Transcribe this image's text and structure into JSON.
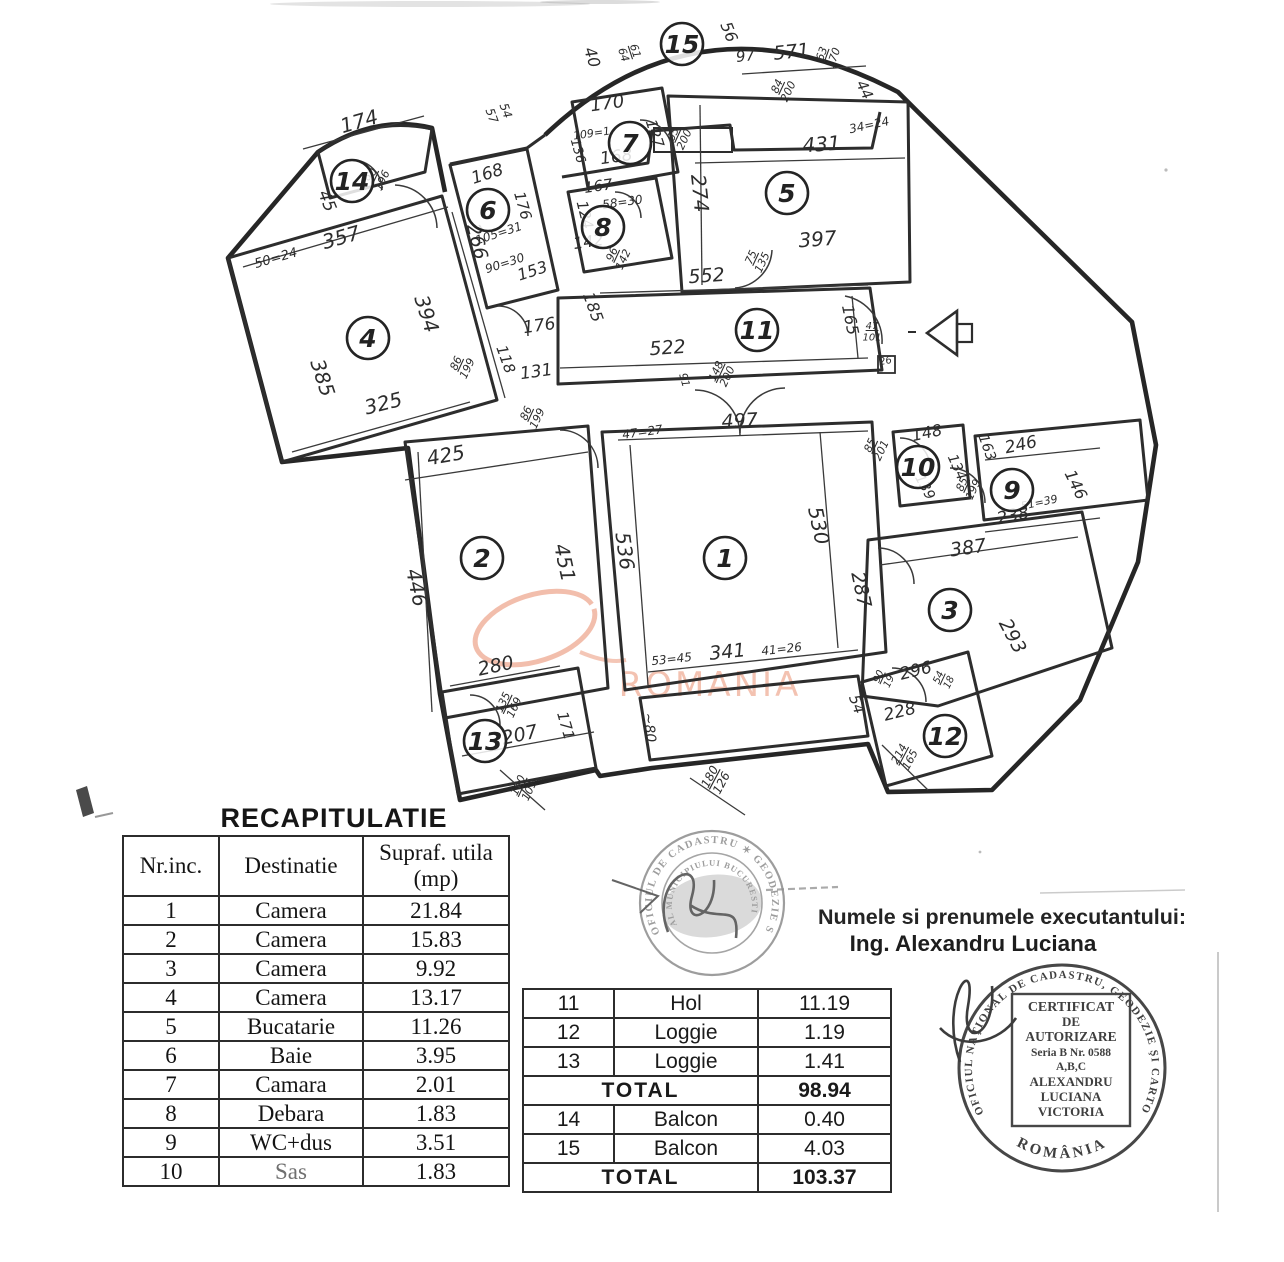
{
  "recap": {
    "title": "RECAPITULATIE",
    "headers": {
      "col1": "Nr.inc.",
      "col2": "Destinatie",
      "col3a": "Supraf. utila",
      "col3b": "(mp)"
    },
    "rows": [
      [
        "1",
        "Camera",
        "21.84"
      ],
      [
        "2",
        "Camera",
        "15.83"
      ],
      [
        "3",
        "Camera",
        "9.92"
      ],
      [
        "4",
        "Camera",
        "13.17"
      ],
      [
        "5",
        "Bucatarie",
        "11.26"
      ],
      [
        "6",
        "Baie",
        "3.95"
      ],
      [
        "7",
        "Camara",
        "2.01"
      ],
      [
        "8",
        "Debara",
        "1.83"
      ],
      [
        "9",
        "WC+dus",
        "3.51"
      ],
      [
        "10",
        "Sas",
        "1.83"
      ]
    ]
  },
  "annex": {
    "rows": [
      {
        "n": "11",
        "d": "Hol",
        "v": "11.19"
      },
      {
        "n": "12",
        "d": "Loggie",
        "v": "1.19"
      },
      {
        "n": "13",
        "d": "Loggie",
        "v": "1.41"
      },
      {
        "total": "TOTAL",
        "v": "98.94"
      },
      {
        "n": "14",
        "d": "Balcon",
        "v": "0.40"
      },
      {
        "n": "15",
        "d": "Balcon",
        "v": "4.03"
      },
      {
        "total": "TOTAL",
        "v": "103.37"
      }
    ]
  },
  "executant": {
    "line1": "Numele si prenumele executantului:",
    "line2": "Ing. Alexandru Luciana"
  },
  "watermark": {
    "text": "ROMANIA",
    "color": "#ec9d82"
  },
  "stamps": {
    "cadastru": {
      "ring": "OFICIUL DE CADASTRU  ✶  GEODEZIE SI CARTOGRAFIE",
      "inner": "AL MUNICIPIULUI BUCURESTI"
    },
    "cert": {
      "ring": "OFICIUL NAŢIONAL DE CADASTRU, GEODEZIE ŞI CARTOGRAFIE",
      "bottom": "ROMÂNIA",
      "box_lines": [
        "CERTIFICAT",
        "DE",
        "AUTORIZARE",
        "Seria B Nr. 0588",
        "A,B,C",
        "ALEXANDRU",
        "LUCIANA",
        "VICTORIA"
      ]
    }
  },
  "floorplan": {
    "rooms": [
      [
        "1",
        725,
        558
      ],
      [
        "2",
        482,
        558
      ],
      [
        "3",
        950,
        610
      ],
      [
        "4",
        368,
        338
      ],
      [
        "5",
        787,
        193
      ],
      [
        "6",
        488,
        210
      ],
      [
        "7",
        630,
        143
      ],
      [
        "8",
        603,
        227
      ],
      [
        "9",
        1012,
        490
      ],
      [
        "10",
        918,
        467
      ],
      [
        "11",
        757,
        330
      ],
      [
        "12",
        945,
        736
      ],
      [
        "13",
        485,
        741
      ],
      [
        "14",
        352,
        181
      ],
      [
        "15",
        682,
        44
      ]
    ],
    "dims": [
      [
        "174",
        361,
        128,
        -16,
        20
      ],
      [
        "45",
        322,
        203,
        68,
        17
      ],
      [
        "90/196",
        377,
        178,
        -65,
        11
      ],
      [
        "50=24",
        277,
        262,
        -16,
        13
      ],
      [
        "357",
        343,
        244,
        -16,
        20
      ],
      [
        "394",
        420,
        316,
        72,
        20
      ],
      [
        "385",
        316,
        380,
        72,
        20
      ],
      [
        "325",
        385,
        410,
        -14,
        20
      ],
      [
        "57",
        488,
        117,
        70,
        12
      ],
      [
        "54",
        502,
        112,
        70,
        12
      ],
      [
        "168",
        489,
        179,
        -18,
        17
      ],
      [
        "176",
        518,
        207,
        74,
        15
      ],
      [
        "266",
        471,
        243,
        76,
        19
      ],
      [
        "105=31",
        500,
        237,
        -18,
        12
      ],
      [
        "90=30",
        506,
        267,
        -18,
        12
      ],
      [
        "153",
        534,
        276,
        -18,
        16
      ],
      [
        "170",
        608,
        109,
        -8,
        18
      ],
      [
        "109=1",
        592,
        137,
        -8,
        11
      ],
      [
        "127",
        650,
        135,
        72,
        15
      ],
      [
        "136",
        574,
        152,
        74,
        13
      ],
      [
        "168",
        617,
        162,
        -8,
        17
      ],
      [
        "65/200",
        679,
        137,
        -65,
        11
      ],
      [
        "167",
        599,
        191,
        -8,
        15
      ],
      [
        "58=30",
        623,
        206,
        -8,
        12
      ],
      [
        "124",
        580,
        216,
        76,
        15
      ],
      [
        "142",
        589,
        247,
        -8,
        16
      ],
      [
        "96/142",
        618,
        257,
        -65,
        11
      ],
      [
        "40",
        587,
        59,
        72,
        16
      ],
      [
        "61/64",
        629,
        53,
        72,
        11
      ],
      [
        "56",
        724,
        34,
        68,
        16
      ],
      [
        "97",
        746,
        61,
        -6,
        15
      ],
      [
        "571",
        792,
        58,
        -6,
        19
      ],
      [
        "63/170",
        828,
        56,
        -70,
        11
      ],
      [
        "84/200",
        783,
        89,
        -65,
        11
      ],
      [
        "44",
        860,
        92,
        64,
        15
      ],
      [
        "34=24",
        870,
        129,
        -12,
        12
      ],
      [
        "431",
        822,
        151,
        -4,
        20
      ],
      [
        "274",
        693,
        194,
        84,
        20
      ],
      [
        "397",
        818,
        246,
        -4,
        20
      ],
      [
        "75/135",
        757,
        260,
        -65,
        11
      ],
      [
        "552",
        707,
        282,
        -4,
        19
      ],
      [
        "522",
        668,
        354,
        -4,
        19
      ],
      [
        "165",
        845,
        321,
        78,
        16
      ],
      [
        "47/101",
        872,
        332,
        0,
        10
      ],
      [
        "26",
        886,
        364,
        -10,
        10
      ],
      [
        "148/200",
        722,
        374,
        -65,
        11
      ],
      [
        "91",
        681,
        381,
        74,
        11
      ],
      [
        "86/199",
        462,
        366,
        -65,
        11
      ],
      [
        "118",
        501,
        361,
        70,
        15
      ],
      [
        "176",
        540,
        331,
        -8,
        17
      ],
      [
        "185",
        588,
        309,
        70,
        16
      ],
      [
        "131",
        537,
        377,
        -8,
        17
      ],
      [
        "86/199",
        532,
        416,
        -65,
        11
      ],
      [
        "497",
        740,
        427,
        -3,
        19
      ],
      [
        "47=27",
        643,
        436,
        -8,
        12
      ],
      [
        "425",
        447,
        462,
        -10,
        20
      ],
      [
        "446",
        410,
        589,
        78,
        20
      ],
      [
        "451",
        558,
        564,
        78,
        20
      ],
      [
        "536",
        618,
        552,
        82,
        20
      ],
      [
        "530",
        812,
        527,
        78,
        20
      ],
      [
        "287",
        855,
        591,
        78,
        19
      ],
      [
        "53=45",
        672,
        663,
        -6,
        12
      ],
      [
        "341",
        728,
        658,
        -6,
        19
      ],
      [
        "41=26",
        782,
        653,
        -6,
        12
      ],
      [
        "~80",
        645,
        728,
        84,
        14
      ],
      [
        "180/126",
        716,
        780,
        -62,
        12
      ],
      [
        "280",
        497,
        672,
        -12,
        19
      ],
      [
        "135/169",
        509,
        705,
        -65,
        11
      ],
      [
        "207",
        521,
        741,
        -12,
        19
      ],
      [
        "171",
        561,
        727,
        74,
        15
      ],
      [
        "190/101",
        524,
        788,
        -65,
        11
      ],
      [
        "85/201",
        876,
        448,
        -65,
        11
      ],
      [
        "148",
        928,
        438,
        -12,
        16
      ],
      [
        "139",
        921,
        489,
        62,
        14
      ],
      [
        "134",
        953,
        469,
        66,
        14
      ],
      [
        "163",
        983,
        449,
        70,
        14
      ],
      [
        "246",
        1022,
        450,
        -12,
        17
      ],
      [
        "146",
        1071,
        487,
        64,
        16
      ],
      [
        "85/199",
        968,
        487,
        -65,
        11
      ],
      [
        "51=39",
        1040,
        506,
        -12,
        11
      ],
      [
        "238",
        1014,
        521,
        -12,
        17
      ],
      [
        "387",
        969,
        554,
        -8,
        19
      ],
      [
        "293",
        1007,
        639,
        62,
        19
      ],
      [
        "296",
        917,
        676,
        -14,
        17
      ],
      [
        "90/19",
        884,
        679,
        -65,
        10
      ],
      [
        "54/18",
        944,
        680,
        -65,
        10
      ],
      [
        "54",
        852,
        706,
        70,
        15
      ],
      [
        "228",
        901,
        717,
        -14,
        17
      ],
      [
        "214/165",
        905,
        757,
        -62,
        11
      ]
    ]
  }
}
